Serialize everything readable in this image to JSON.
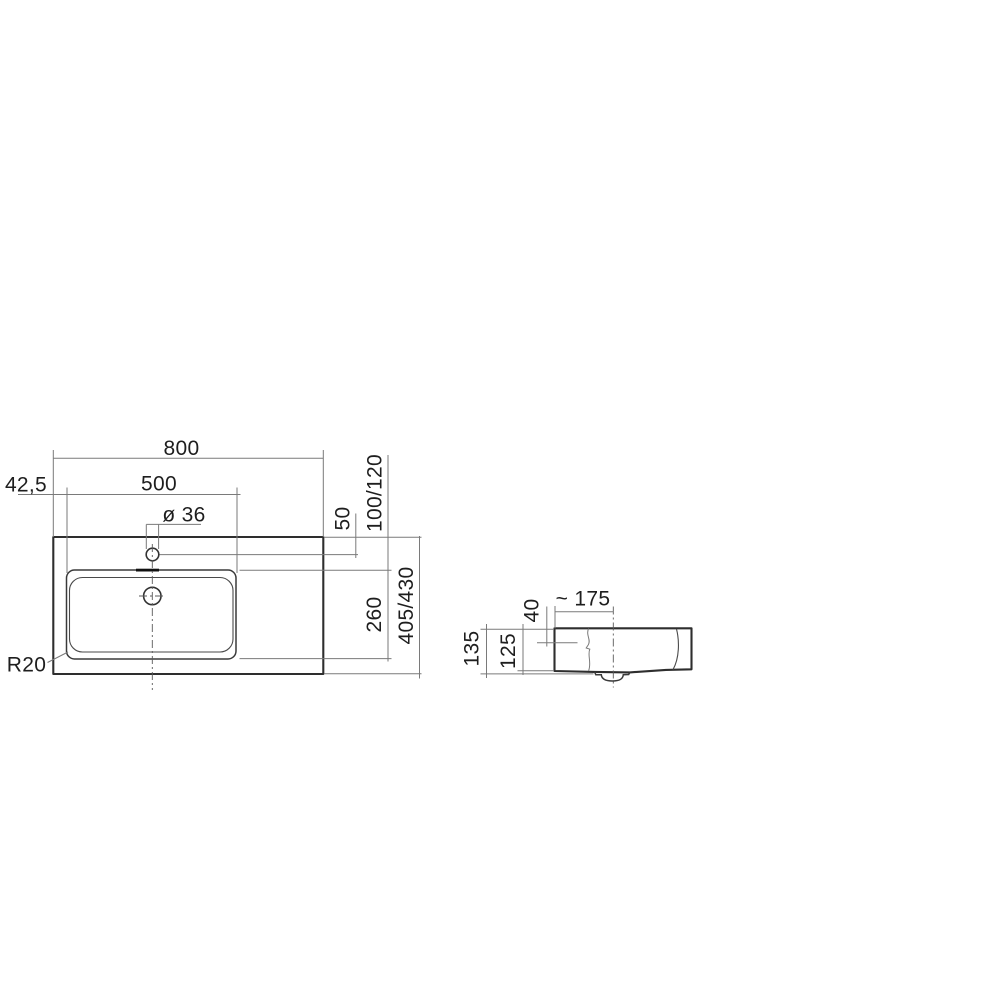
{
  "drawing": {
    "type": "technical-dimension-drawing",
    "subject": "washbasin with tap hole and drain, plan view and side section",
    "units": "mm",
    "colors": {
      "background": "#ffffff",
      "object_line": "#2e2e2e",
      "dimension_line": "#7a7a7a",
      "text": "#1e1e1e"
    },
    "dimensions": {
      "plan": {
        "total_width": "800",
        "left_offset": "42,5",
        "basin_width": "500",
        "tap_hole_diameter": "ø 36",
        "tap_hole_offset": "50",
        "back_ledge_depth": "100/120",
        "basin_depth": "260",
        "total_depth": "405/430",
        "corner_radius": "R20"
      },
      "side": {
        "drain_offset": "~ 175",
        "hole_distance": "40",
        "total_height": "135",
        "body_height": "125"
      }
    }
  }
}
